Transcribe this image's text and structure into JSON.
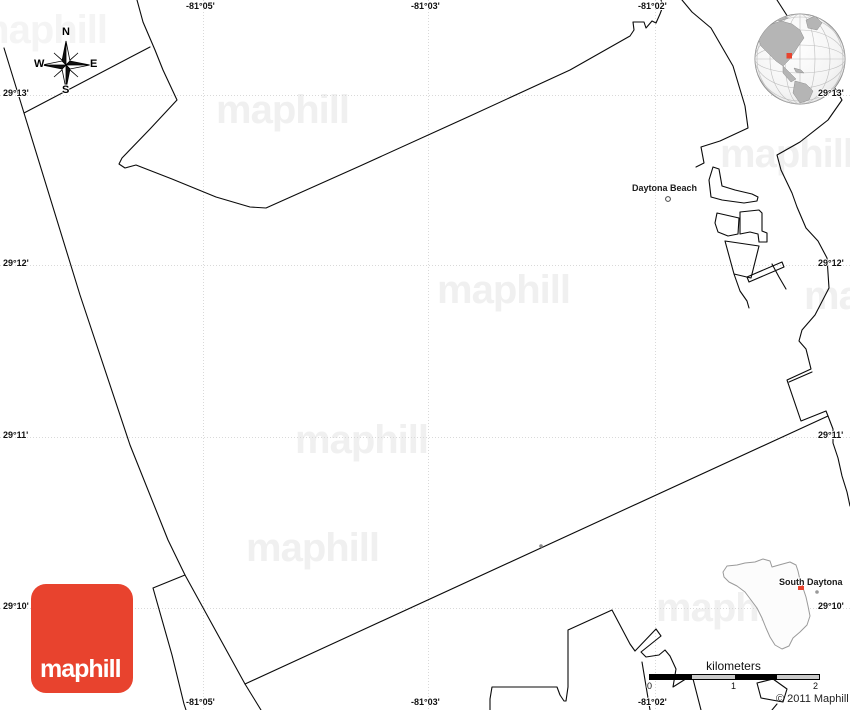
{
  "page": {
    "width": 850,
    "height": 710
  },
  "grid": {
    "longitudes": [
      "-81°05'",
      "-81°03'",
      "-81°02'"
    ],
    "latitudes": [
      "29°13'",
      "29°12'",
      "29°11'",
      "29°10'"
    ]
  },
  "map": {
    "city_label": "Daytona Beach",
    "watermark_text": "maphill"
  },
  "compass": {
    "n": "N",
    "s": "S",
    "e": "E",
    "w": "W"
  },
  "inset": {
    "city_label": "South Daytona"
  },
  "scalebar": {
    "unit": "kilometers",
    "ticks": [
      "0",
      "1",
      "2"
    ]
  },
  "branding": {
    "logo": "maphill",
    "copyright": "© 2011 Maphill"
  },
  "colors": {
    "logo_red": "#e8432e",
    "marker_red": "#e73c2a",
    "map_line": "#000000",
    "watermark_gray": "#f0f0f0",
    "gridline_gray": "#d9d9d9"
  }
}
